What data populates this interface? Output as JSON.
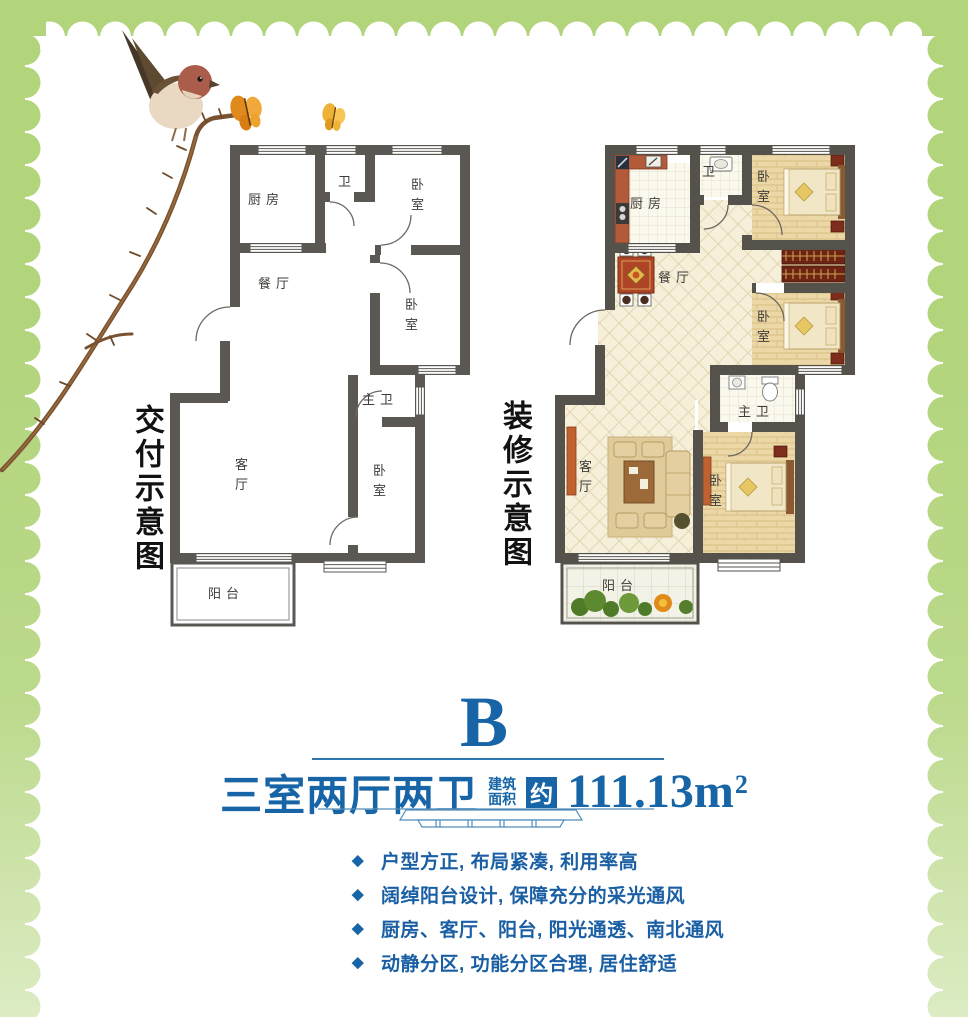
{
  "colors": {
    "border_green": "#b2d47b",
    "accent_blue": "#1765a6",
    "wall_gray": "#57534e"
  },
  "decor": {
    "illustration": "sparrow-on-thorn-branch",
    "butterflies": "2"
  },
  "plans": {
    "left": {
      "caption": "交付示意图",
      "rooms": {
        "kitchen": "厨房",
        "bath": "卫",
        "bedroom_top": "卧室",
        "dining": "餐厅",
        "bedroom_mid": "卧室",
        "master_bath": "主卫",
        "living": "客厅",
        "bedroom_bottom": "卧室",
        "balcony": "阳台"
      }
    },
    "right": {
      "caption": "装修示意图",
      "rooms": {
        "kitchen": "厨房",
        "bath": "卫",
        "bedroom_top": "卧室",
        "dining": "餐厅",
        "bedroom_mid": "卧室",
        "master_bath": "主卫",
        "living": "客厅",
        "bedroom_bottom": "卧室",
        "balcony": "阳台"
      }
    }
  },
  "unit": {
    "letter": "B",
    "layout_title": "三室两厅两卫",
    "area_label_top": "建筑",
    "area_label_bottom": "面积",
    "area_approx": "约",
    "area_value": "111.13m",
    "area_exponent": "2"
  },
  "features": [
    "户型方正, 布局紧凑, 利用率高",
    "阔绰阳台设计, 保障充分的采光通风",
    "厨房、客厅、阳台, 阳光通透、南北通风",
    "动静分区, 功能分区合理, 居住舒适"
  ],
  "bullet_icon": "◆"
}
